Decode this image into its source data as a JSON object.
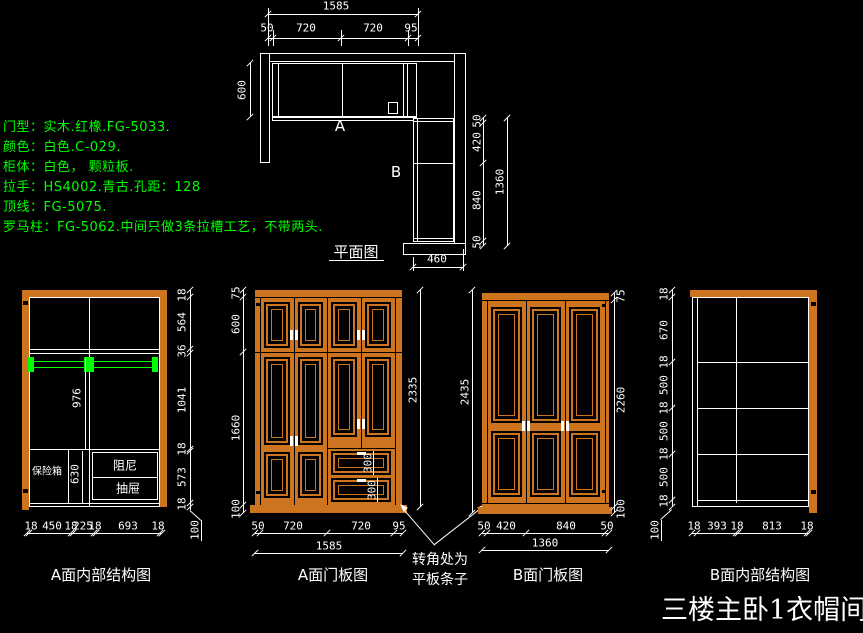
{
  "title": "三楼主卧1衣帽间",
  "specs": {
    "line1": "门型：实木.红橡.FG-5033.",
    "line2": "颜色：白色.C-029.",
    "line3": "柜体：白色， 颗粒板.",
    "line4": "拉手：HS4002.青古.孔距：128",
    "line5": "顶线：FG-5075.",
    "line6": "罗马柱：FG-5062.中间只做3条拉槽工艺，不带两头."
  },
  "plan": {
    "caption": "平面图",
    "label_a": "A",
    "label_b": "B",
    "dim_total_width": "1585",
    "top_chain": [
      "50",
      "720",
      "720",
      "95"
    ],
    "dim_left_depth": "600",
    "right_chain": [
      "50",
      "420",
      "840",
      "50"
    ],
    "dim_right_total": "1360",
    "dim_bottom_depth": "460"
  },
  "elev_a_internal": {
    "caption": "A面内部结构图",
    "right_chain": [
      "18",
      "564",
      "36",
      "1041",
      "18",
      "573",
      "18"
    ],
    "dim_plinth": "100",
    "bottom_chain": [
      "18",
      "450",
      "18",
      "225",
      "18",
      "693",
      "18"
    ],
    "dim_rod_height": "976",
    "dim_safe_col": "630",
    "label_safe": "保险箱",
    "label_drawer_1": "阻尼",
    "label_drawer_2": "抽屉"
  },
  "elev_a_doors": {
    "caption": "A面门板图",
    "left_chain": [
      "75",
      "600",
      "1660",
      "100"
    ],
    "dim_height_total": "2335",
    "bottom_chain": [
      "50",
      "720",
      "720",
      "95"
    ],
    "dim_width_total": "1585",
    "dim_drawer_1": "300",
    "dim_drawer_2": "300"
  },
  "corner_note": {
    "line1": "转角处为",
    "line2": "平板条子"
  },
  "elev_b_doors": {
    "caption": "B面门板图",
    "dim_height_total": "2435",
    "right_chain": [
      "75",
      "2260",
      "100"
    ],
    "bottom_chain": [
      "50",
      "420",
      "840",
      "50"
    ],
    "dim_width_total": "1360"
  },
  "elev_b_internal": {
    "caption": "B面内部结构图",
    "left_chain": [
      "18",
      "670",
      "18",
      "500",
      "18",
      "500",
      "18",
      "500",
      "18"
    ],
    "dim_plinth": "100",
    "bottom_chain": [
      "18",
      "393",
      "18",
      "813",
      "18"
    ]
  },
  "colors": {
    "wood": "#CE731E",
    "green": "#00FF00",
    "line": "#FFFFFF",
    "background": "#000000"
  }
}
